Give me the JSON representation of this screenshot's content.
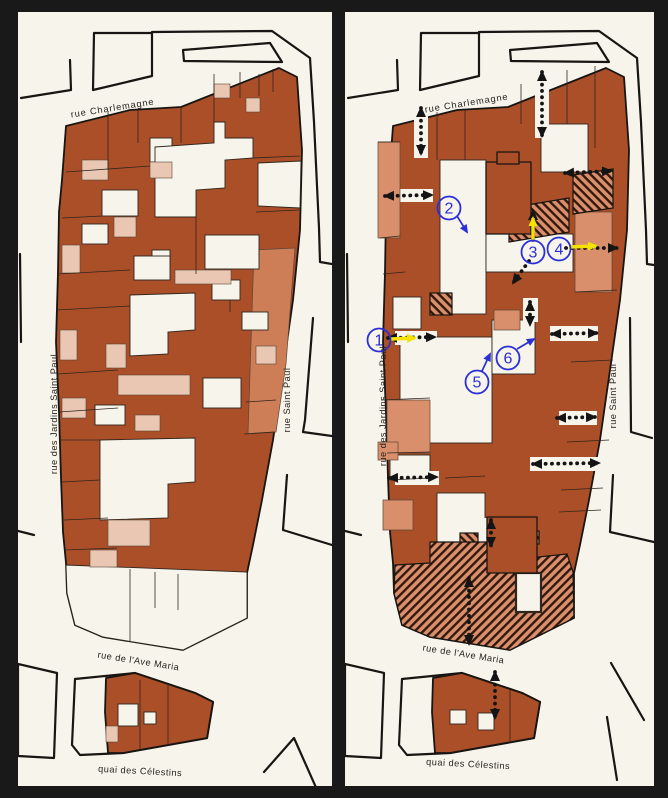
{
  "page": {
    "background": "#191919",
    "panel_background": "#f7f4ec"
  },
  "palette": {
    "building_dark": "#ab4f29",
    "building_medium": "#cd7e57",
    "building_light": "#e9c7b3",
    "building_salmon": "#d98f6c",
    "outline_black": "#181512",
    "marker_blue": "#2a2fd6",
    "arrow_yellow": "#f4e300",
    "passage_black": "#141414",
    "hatch_stripe": "#33190c"
  },
  "left_map": {
    "streets": {
      "top": "rue Charlemagne",
      "left": "rue des Jardins Saint Paul",
      "right": "rue Saint Paul",
      "bottom": "rue de l'Ave Maria",
      "quay": "quai des Célestins"
    }
  },
  "right_map": {
    "streets": {
      "top": "rue Charlemagne",
      "left": "rue des Jardins Saint Paul",
      "right": "rue Saint Paul",
      "bottom": "rue de l'Ave Maria",
      "quay": "quai des Célestins"
    },
    "markers": [
      {
        "number": "1"
      },
      {
        "number": "2"
      },
      {
        "number": "3"
      },
      {
        "number": "4"
      },
      {
        "number": "5"
      },
      {
        "number": "6"
      }
    ]
  },
  "icons": {
    "passage-arrow-icon": "black dotted double-headed arrow",
    "yellow-arrow-icon": "solid yellow direction arrow",
    "blue-pointer-icon": "thin blue pointer arrow",
    "hatched-parcel-icon": "diagonal striped parcel"
  }
}
